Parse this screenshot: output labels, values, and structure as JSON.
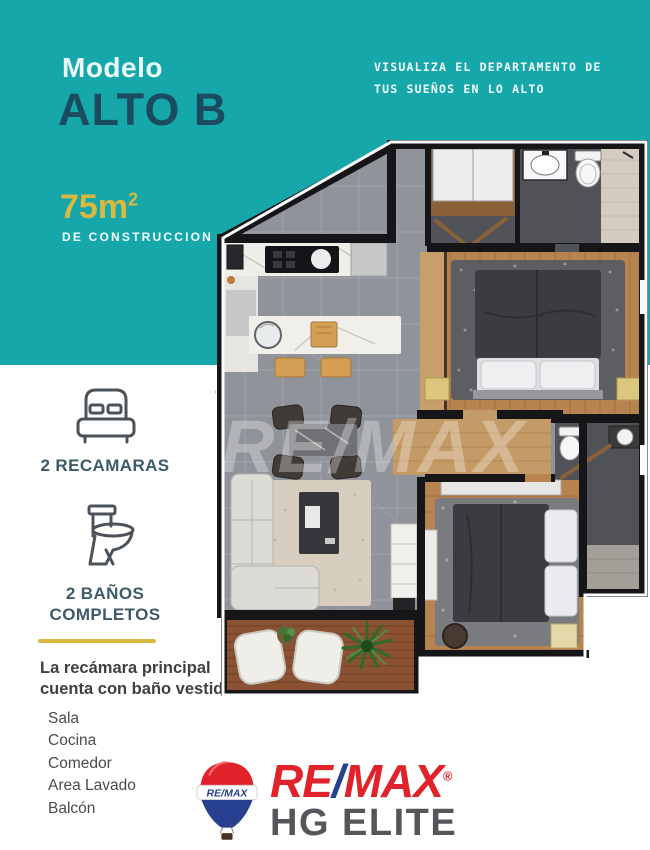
{
  "colors": {
    "teal": "#16A7AA",
    "navy": "#1B4B5E",
    "yellow": "#D9B93F",
    "remax_red": "#E0232B",
    "remax_blue": "#27408F",
    "logo_gray": "#55565A"
  },
  "header": {
    "model_label": "Modelo",
    "model_name": "ALTO B",
    "tagline_line1": "VISUALIZA EL DEPARTAMENTO DE",
    "tagline_line2": "TUS SUEÑOS EN LO ALTO",
    "area_value": "75m",
    "area_sup": "2",
    "area_caption": "DE CONSTRUCCION"
  },
  "features": {
    "bedrooms_label": "2 RECAMARAS",
    "bathrooms_label_line1": "2 BAÑOS",
    "bathrooms_label_line2": "COMPLETOS"
  },
  "description": {
    "line1": "La recámara principal",
    "line2": "cuenta con baño vestidor"
  },
  "amenities": {
    "items": [
      "Sala",
      "Cocina",
      "Comedor",
      "Area Lavado",
      "Balcón"
    ]
  },
  "floorplan": {
    "watermark": "RE/MAX"
  },
  "footer": {
    "balloon_text": "RE/MAX",
    "brand_re": "RE",
    "brand_slash": "/",
    "brand_max": "MAX",
    "brand_reg": "®",
    "brand_sub": "HG ELITE"
  }
}
